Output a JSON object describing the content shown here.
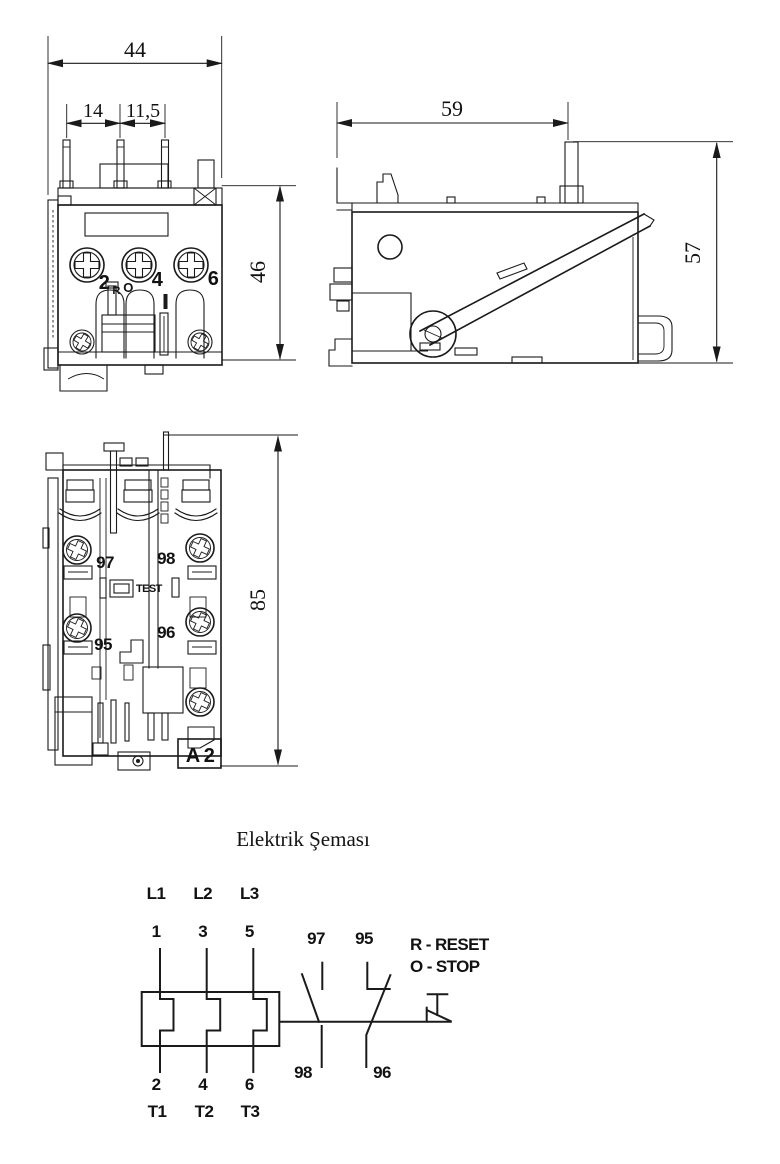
{
  "page": {
    "background": "#ffffff",
    "line_color": "#1a1a1a"
  },
  "views": {
    "front": {
      "dim_width_total": "44",
      "dim_pin_left": "14",
      "dim_pin_right": "11,5",
      "dim_height": "46",
      "terminals": [
        "2",
        "4",
        "6"
      ],
      "reset_mark": "R",
      "stop_mark": "O"
    },
    "side": {
      "dim_depth": "59",
      "dim_height": "57"
    },
    "bottom": {
      "dim_height": "85",
      "no_top": "97",
      "no_bottom": "98",
      "nc_top": "95",
      "nc_bottom": "96",
      "test_label": "TEST",
      "terminal_a2": "A 2"
    }
  },
  "schematic": {
    "title": "Elektrik Şeması",
    "lines_top": [
      "L1",
      "L2",
      "L3"
    ],
    "poles_top": [
      "1",
      "3",
      "5"
    ],
    "poles_bottom": [
      "2",
      "4",
      "6"
    ],
    "lines_bottom": [
      "T1",
      "T2",
      "T3"
    ],
    "no_contact": {
      "top": "97",
      "bottom": "98"
    },
    "nc_contact": {
      "top": "95",
      "bottom": "96"
    },
    "legend": {
      "reset": "R - RESET",
      "stop": "O - STOP"
    }
  }
}
